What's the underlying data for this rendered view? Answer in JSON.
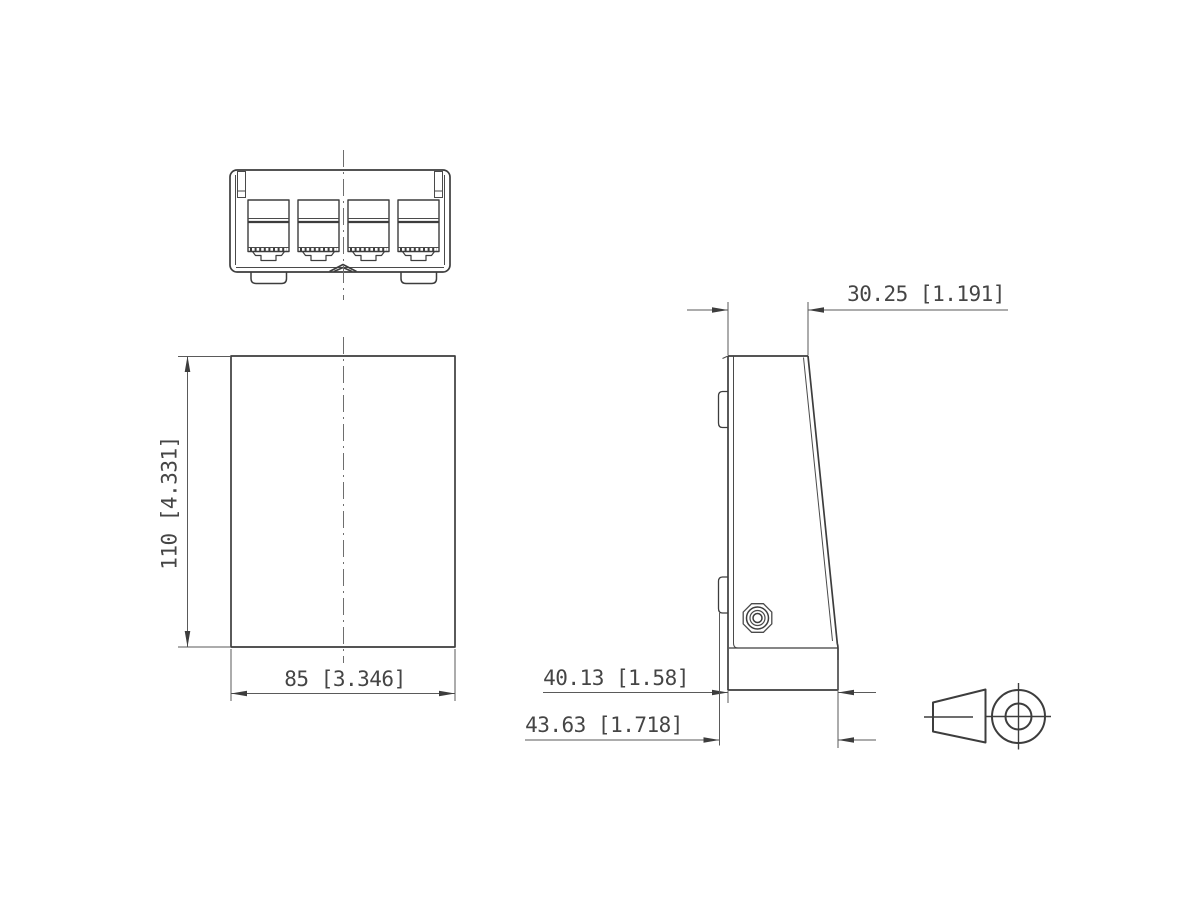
{
  "colors": {
    "background": "#ffffff",
    "line": "#3d3d3d",
    "dim_line": "#5a5a5a",
    "text": "#454545"
  },
  "dimensions": {
    "front_width": "85 [3.346]",
    "front_height": "110 [4.331]",
    "side_top_depth": "30.25 [1.191]",
    "side_body_depth": "40.13 [1.58]",
    "side_overall_depth": "43.63 [1.718]"
  },
  "icons": {
    "projection_symbol": "first-angle-projection-icon"
  }
}
